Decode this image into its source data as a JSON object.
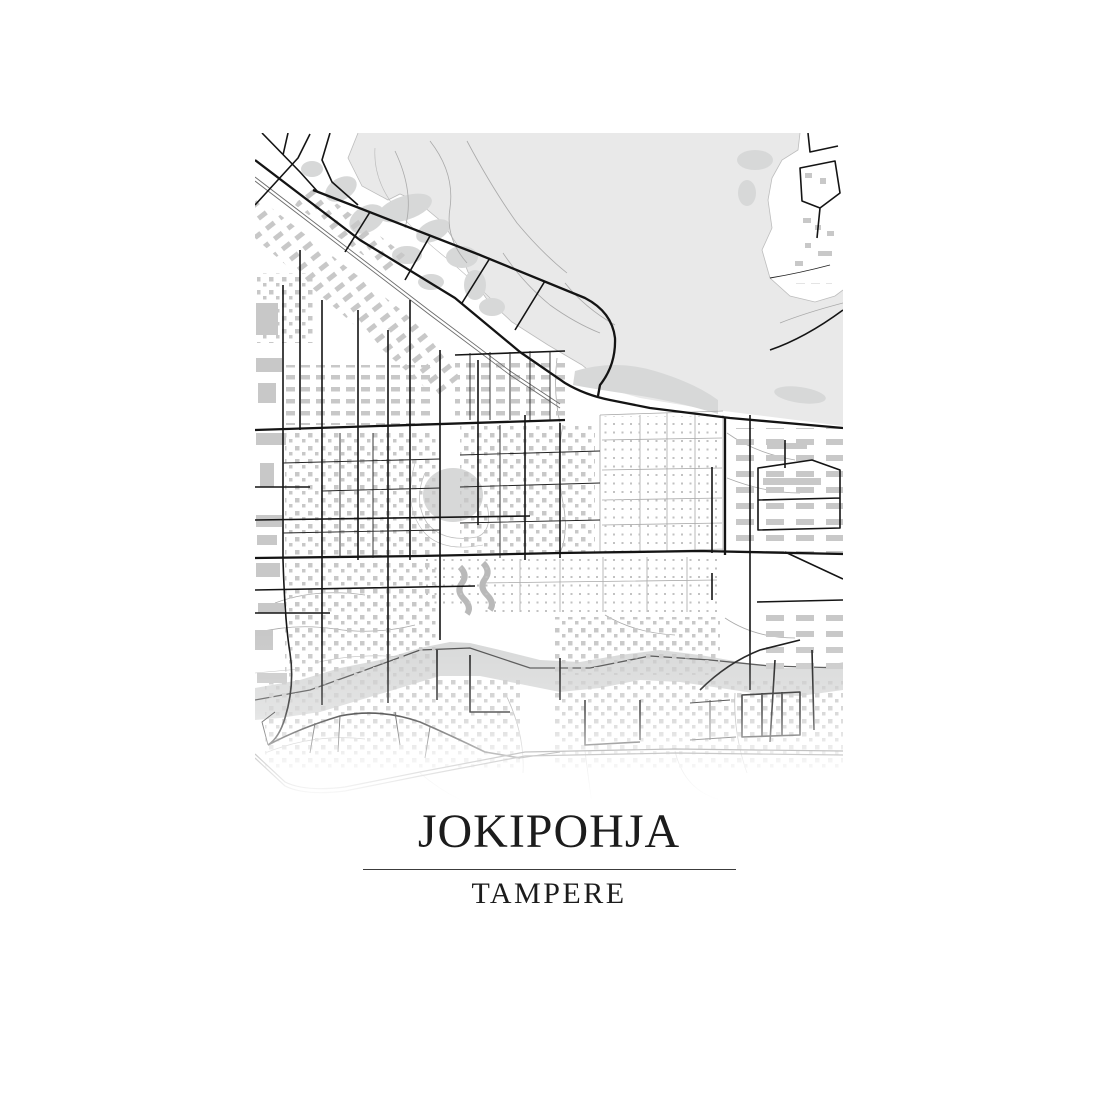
{
  "poster": {
    "title": "JOKIPOHJA",
    "subtitle": "TAMPERE"
  },
  "colors": {
    "water": "#e9e9e9",
    "greenery": "#d7d8d8",
    "building": "#c8c8c8",
    "dots": "#c2c2c2",
    "road": "#141414",
    "road_minor": "#a9a9a9",
    "river_line": "#4a4a4a",
    "text": "#1c1c1c",
    "divider": "#3c3c3c",
    "paper": "#ffffff"
  }
}
